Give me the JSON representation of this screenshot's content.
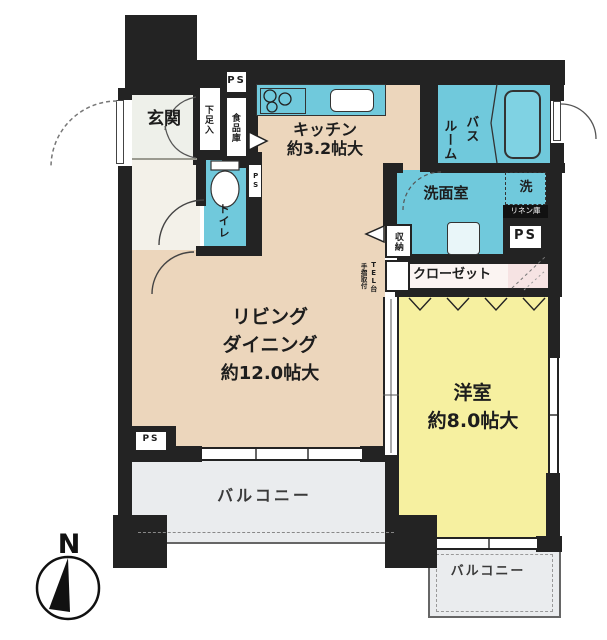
{
  "compass": {
    "north_label": "N"
  },
  "rooms": {
    "genkan": {
      "label": "玄関"
    },
    "shoe_cabinet": {
      "label": "下足入"
    },
    "ps_top": {
      "label": "PS"
    },
    "pantry": {
      "label": "食品庫"
    },
    "toilet": {
      "label": "トイレ"
    },
    "ps_toilet": {
      "label": "PS"
    },
    "kitchen": {
      "label": "キッチン",
      "size": "約3.2帖大"
    },
    "bathroom": {
      "label_col1": "バス",
      "label_col2": "ルーム"
    },
    "washroom": {
      "label": "洗面室"
    },
    "laundry": {
      "label": "洗"
    },
    "linen": {
      "label": "リネン庫"
    },
    "ps_right": {
      "label": "PS"
    },
    "storage": {
      "label": "収納"
    },
    "tel_stand": {
      "label": "TEL台",
      "note": "手摺取付"
    },
    "closet": {
      "label": "クローゼット"
    },
    "living_dining": {
      "label_line1": "リビング",
      "label_line2": "ダイニング",
      "size": "約12.0帖大"
    },
    "western_room": {
      "label": "洋室",
      "size": "約8.0帖大"
    },
    "balcony_main": {
      "label": "バルコニー"
    },
    "balcony_sub": {
      "label": "バルコニー"
    },
    "ps_bottom": {
      "label": "PS"
    }
  },
  "colors": {
    "wall": "#232323",
    "wet_area": "#70c9dc",
    "living_floor": "#ecd6bc",
    "bedroom_floor": "#f6f0a0",
    "balcony_floor": "#eaecee",
    "hatch_area": "#f6e3e3"
  }
}
